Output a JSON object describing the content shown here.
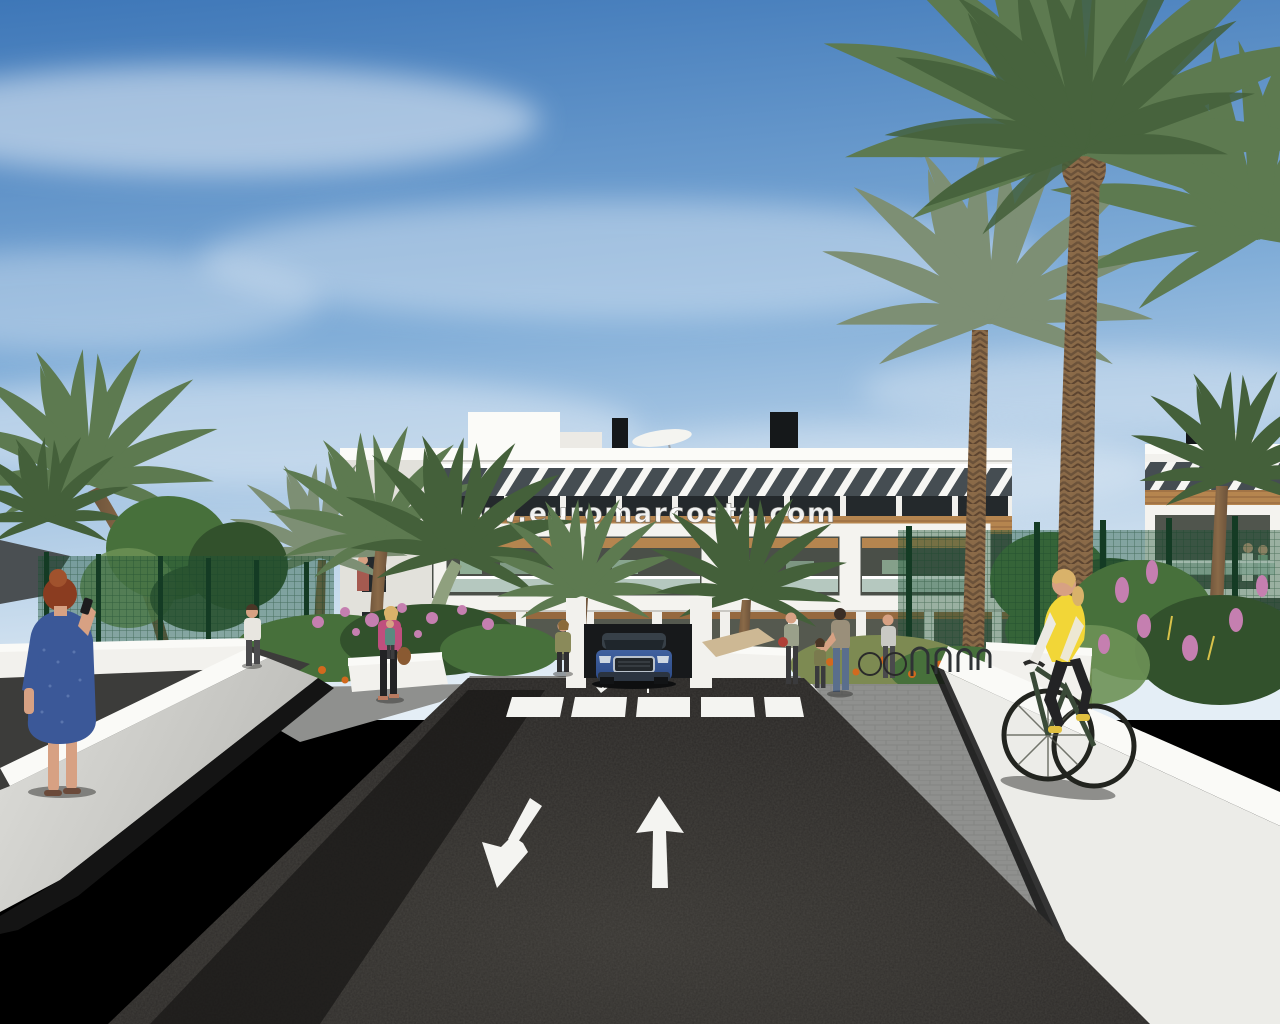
{
  "watermark": {
    "text": "www.euromarcosta.com"
  },
  "scene": {
    "type": "architectural-render-photo",
    "description": "New-build Mediterranean apartment complex seen from its entrance road. A dark asphalt two-way road with painted white lane arrows and a zebra crossing leads to the building. A blue SUV exits an underground garage ramp in the centre. White perimeter walls flank the road; a woman in a blue dress talks on the phone at left foreground, a cyclist in a yellow vest rides on the right-hand paved path. Gardens with pink and orange flowers, green mesh fences and tall date palms surround the white three-storey residences with wood pergolas and glass balconies under a blue sky.",
    "objects": [
      "sky with wispy clouds",
      "three-storey white apartment building with wood pergola bands and striped roof pergola",
      "rooftop chimneys and white parasols",
      "watermark text over facade",
      "tall date palms and smaller palms",
      "round leafy trees",
      "green mesh garden fences",
      "flower beds with pink and orange blooms",
      "white perimeter walls",
      "dark asphalt road with up arrow and down-left arrow markings",
      "zebra crosswalk",
      "underground garage ramp with blue SUV",
      "woman with red hair in blue dress on phone",
      "man walking on left path",
      "woman in pink jacket with handbag",
      "woman standing near garage ramp",
      "group with mother, child and bicycles near bike racks",
      "cyclist in yellow vest on paver path",
      "tiny figures on balconies"
    ]
  },
  "palette": {
    "sky_top": "#3e77b8",
    "sky_mid": "#82aed8",
    "sky_horizon": "#cfe0ef",
    "cloud": "#eaf1f8",
    "building_white": "#f2f1ed",
    "building_bright": "#fbfbf8",
    "building_shade": "#e2e1db",
    "pergola_dark": "#454d52",
    "wood": "#b5854f",
    "wood_dark": "#96693f",
    "window_dark": "#24292c",
    "interior_dark": "#4a4f48",
    "glass": "#c8ddd5",
    "furniture_green": "#8fae96",
    "asphalt": "#292725",
    "asphalt_light": "#3a3733",
    "road_marking": "#f4f4f1",
    "sidewalk": "#8f908e",
    "path_dark": "#3c3c3a",
    "wall_bright": "#fafaf7",
    "wall_face": "#dededa",
    "wall_deep": "#bcbcb8",
    "shadow_black": "#141414",
    "fence_green": "#1d5435",
    "fence_post": "#143b24",
    "foliage_dark": "#32512c",
    "foliage_mid": "#47703b",
    "foliage_light": "#6d9156",
    "palm_green": "#5d7a50",
    "palm_dark": "#44603a",
    "palm_gray": "#7d8f74",
    "trunk_brown": "#8a6a48",
    "trunk_dark": "#6b523a",
    "flower_pink": "#c57fb0",
    "flower_orange": "#d2691e",
    "grass_olive": "#7d8a52",
    "car_blue": "#40619f",
    "car_blue_dark": "#2c4a86",
    "car_glass": "#1f262c",
    "chrome": "#b9c2cc",
    "skin": "#d7a183",
    "hair_red": "#8a3c20",
    "hair_blonde": "#d9b26a",
    "hair_dark": "#3a2e26",
    "dress_blue": "#3b5898",
    "jacket_pink": "#bf4f7e",
    "shirt_white": "#e8e6e0",
    "pants_dark": "#232325",
    "vest_yellow": "#f2d637",
    "bike_frame": "#3a4a38",
    "bag_brown": "#8a5a32",
    "tan_wedge": "#cdb894"
  }
}
